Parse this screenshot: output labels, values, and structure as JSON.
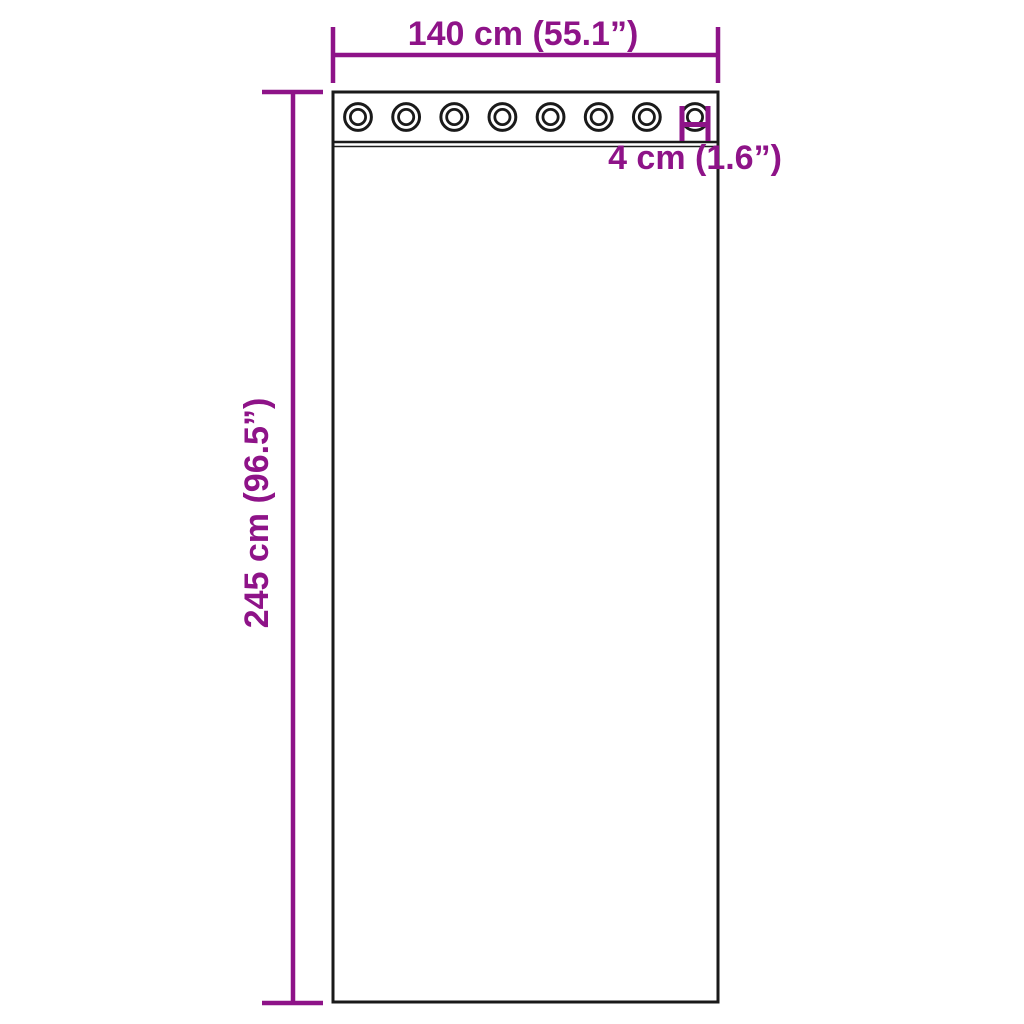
{
  "page": {
    "background_color": "#ffffff"
  },
  "diagram": {
    "type": "product-dimension-diagram",
    "subject": "curtain panel with grommets",
    "accent_color": "#8E1388",
    "outline_color": "#1a1a1a",
    "labels": {
      "width": "140 cm (55.1”)",
      "height": "245 cm (96.5”)",
      "grommet_diameter": "4 cm (1.6”)"
    },
    "grommets": {
      "count": 8
    }
  }
}
